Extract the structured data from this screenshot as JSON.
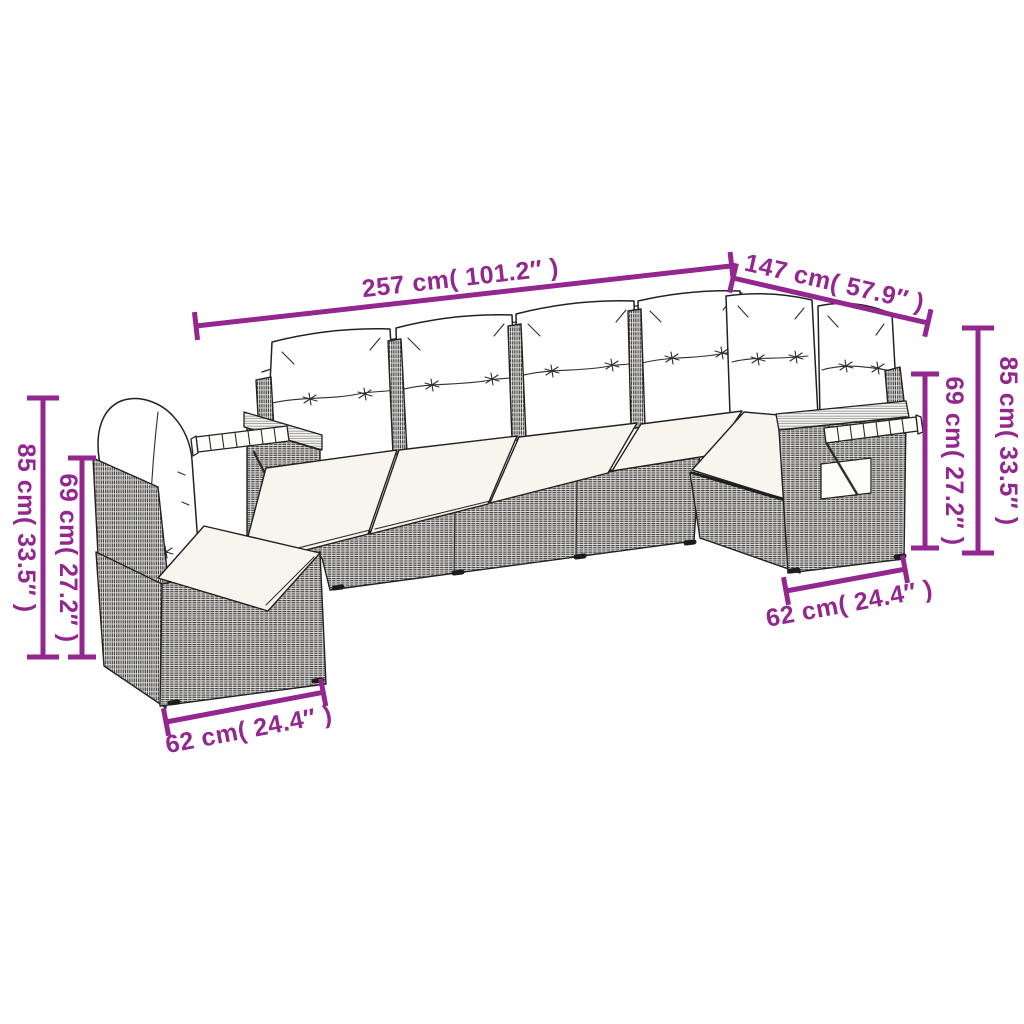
{
  "diagram": {
    "type": "product-dimension-diagram",
    "alt": "Line drawing of an L-shaped poly rattan garden sofa set with back and seat cushions and two fold-out wooden tray shelves",
    "accent_color": "#93278f",
    "line_color": "#222222",
    "dimensions": {
      "total_length": {
        "label": "257 cm( 101.2″ )"
      },
      "corner_section_length": {
        "label": "147 cm( 57.9″ )"
      },
      "right_total_height": {
        "label": "85 cm( 33.5″ )"
      },
      "right_frame_height": {
        "label": "69 cm( 27.2″ )"
      },
      "left_total_height": {
        "label": "85 cm( 33.5″ )"
      },
      "left_frame_height": {
        "label": "69 cm( 27.2″ )"
      },
      "left_module_width": {
        "label": "62 cm( 24.4″ )"
      },
      "right_module_width": {
        "label": "62 cm( 24.4″ )"
      }
    }
  }
}
